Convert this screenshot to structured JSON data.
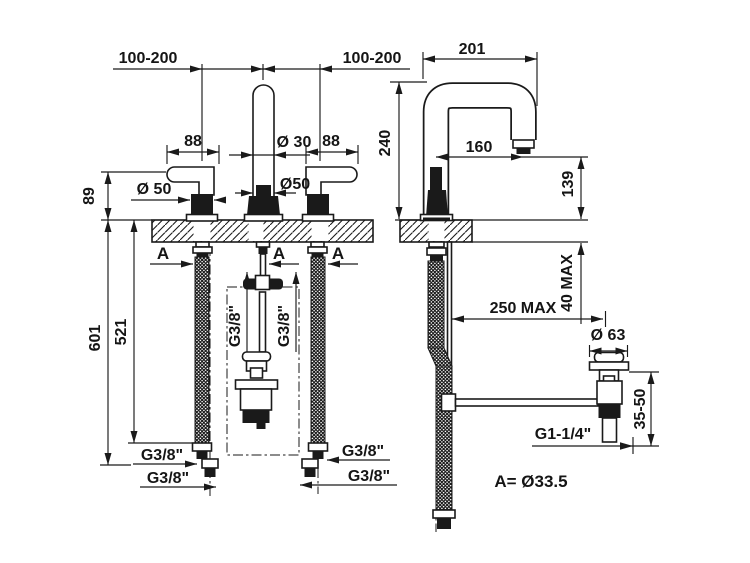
{
  "ink": "#1a1a1a",
  "front_view": {
    "center_spread_left": "100-200",
    "center_spread_right": "100-200",
    "handle_length_left": "88",
    "handle_length_right": "88",
    "spout_diameter": "Ø 30",
    "handle_base_diameter": "Ø 50",
    "spout_base_diameter": "Ø50",
    "handle_height_above_deck": "89",
    "drop_total": "601",
    "drop_to_hose_end": "521",
    "hole_label_left": "A",
    "hole_label_center": "A",
    "hole_label_right": "A",
    "spout_inlet_left": "G3/8\"",
    "spout_inlet_right": "G3/8\"",
    "hose_left_upper": "G3/8\"",
    "hose_left_lower": "G3/8\"",
    "hose_right_upper": "G3/8\"",
    "hose_right_lower": "G3/8\""
  },
  "side_view": {
    "spout_depth": "201",
    "spout_height": "240",
    "spout_reach": "160",
    "spout_outlet_height": "139",
    "deck_thickness_max": "40 MAX",
    "waste_distance_max": "250 MAX",
    "waste_flange_diameter": "Ø 63",
    "waste_height_adjust": "35-50",
    "waste_thread": "G1-1/4\""
  },
  "note": {
    "hole_diameter": "A= Ø33.5"
  }
}
